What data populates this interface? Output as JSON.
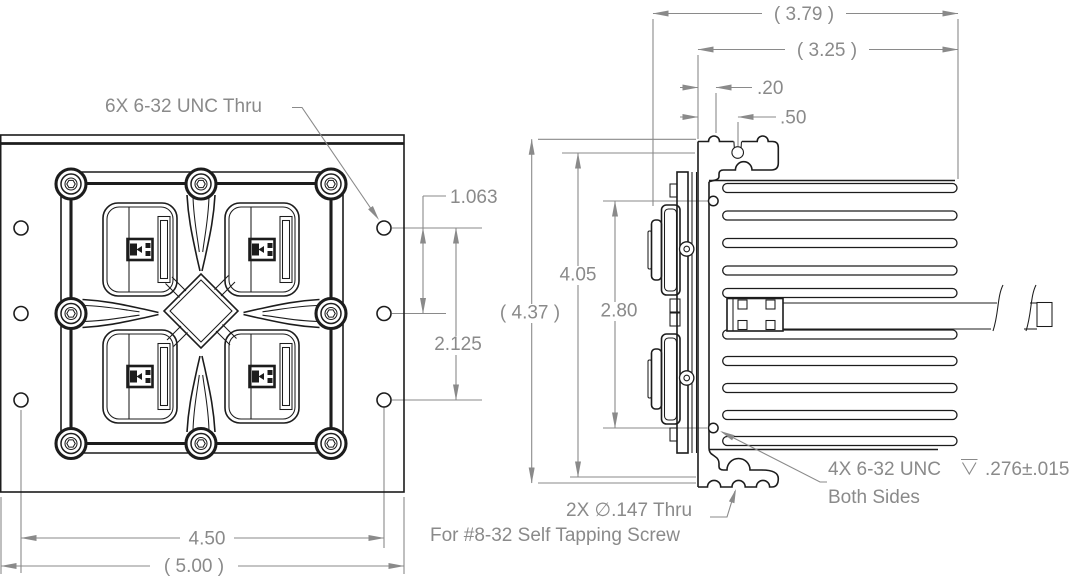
{
  "drawing": {
    "background_color": "#ffffff",
    "geometry_color": "#1c1c1c",
    "dimension_color": "#8a8a8a",
    "front_view": {
      "hole_callout": "6X 6-32 UNC  Thru",
      "dimensions": {
        "hole_row_spacing": "1.063",
        "hole_row_span": "2.125",
        "hole_column_span": "4.50",
        "overall_width": "( 5.00 )"
      }
    },
    "side_view": {
      "dimensions": {
        "overall_depth": "( 3.79 )",
        "fin_depth": "( 3.25 )",
        "base_thickness": ".20",
        "slot_offset": ".50",
        "overall_height": "( 4.37 )",
        "mount_slot_spacing": "4.05",
        "side_hole_spacing": "2.80"
      },
      "tapped_hole_callout": {
        "spec": "4X 6-32 UNC",
        "depth_symbol": "⊽",
        "depth_value": ".276±.015",
        "note": "Both Sides"
      },
      "thru_hole_callout": {
        "line1": "2X ∅.147 Thru",
        "line2": "For #8-32 Self Tapping Screw"
      }
    }
  }
}
